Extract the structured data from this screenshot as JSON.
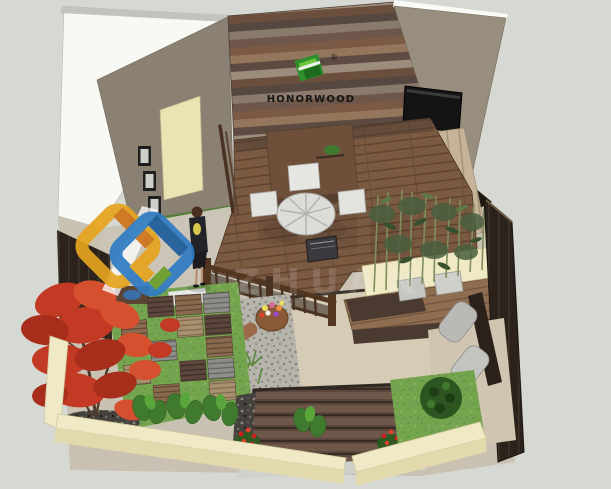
{
  "scene": {
    "type": "3d-courtyard-garden-rendering",
    "description": "Isometric SketchUp-style rendering of a wood-composite decking show garden"
  },
  "brand": {
    "name": "HONORWOOD",
    "registered_mark": "®",
    "logo_icon": "folded-green-square-icon"
  },
  "watermark": {
    "latin_fragment": "ZHUAN",
    "logo_icon": "interlocked-diamonds-icon"
  },
  "colors": {
    "background": "#d6d8d3",
    "wall_white": "#f8f8f4",
    "wall_taupe": "#8b8173",
    "wall_taupe_right": "#988e7e",
    "door_cream": "#e9e4b2",
    "tv_black": "#141414",
    "deck_brown": "#7b5a42",
    "railing_brown": "#4f3722",
    "counter_brown": "#6e4f3a",
    "grass_green": "#74a44e",
    "path_gray": "#cbc5b8",
    "paving_beige": "#d6cbb4",
    "curb_cream": "#f0e9c6",
    "gravel_light": "#b6b4ac",
    "pebble_dark": "#45423e",
    "maple_red": "#c23a24",
    "shrub_green": "#2c5522",
    "bamboo_green": "#4a5f3e",
    "topiary_green": "#55a038",
    "fence_dark": "#2b221b",
    "ramp_brown": "#5a463c",
    "cushion_gray": "#c6c6c2",
    "logo_green": "#2e8f2c",
    "watermark_yellow": "#e6a41e",
    "watermark_blue": "#2f7cc2",
    "white_furniture": "#dcdcd8"
  },
  "objects": [
    "plank-feature-wall",
    "brand-logo",
    "left-wall-with-door",
    "wall-pictures",
    "tv-screen",
    "dining-table-set",
    "bar-counter",
    "deck-railing",
    "wood-deck",
    "stone-path",
    "woman-figure",
    "red-maple-tree",
    "checker-deck-tiles",
    "lawn",
    "gravel-bed",
    "flower-pot",
    "bamboo-planter",
    "topiary-circles",
    "platform-cushions",
    "lounge-chairs",
    "leafy-plants",
    "red-flower-bushes",
    "round-shrub",
    "slatted-ramp",
    "cream-curb-walls",
    "dark-fence",
    "watermark-logo"
  ]
}
